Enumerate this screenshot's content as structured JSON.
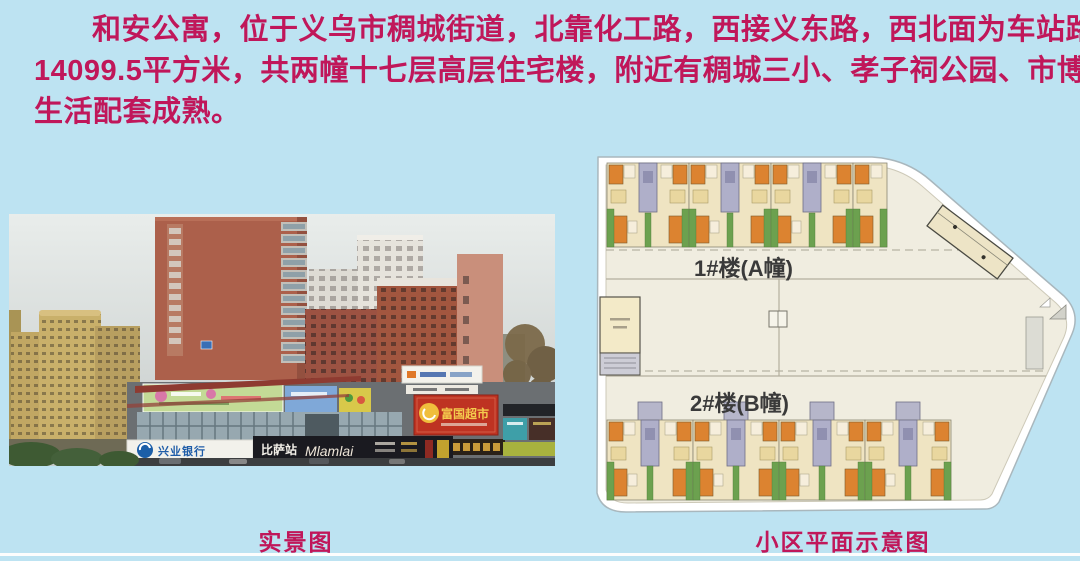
{
  "description": {
    "lines": [
      "和安公寓，位于义乌市稠城街道，北靠化工路，西接义东路，西北面为车站路。小区占地",
      "14099.5平方米，共两幢十七层高层住宅楼，附近有稠城三小、孝子祠公园、市博物馆，周边",
      "生活配套成熟。"
    ]
  },
  "photo": {
    "caption": "实景图",
    "signs": {
      "bank": "兴业银行",
      "pizza": "比萨站",
      "brand": "Mlamlai",
      "market": "富国超市"
    }
  },
  "plan": {
    "caption": "小区平面示意图",
    "building_a": "1#楼(A幢)",
    "building_b": "2#楼(B幢)",
    "row_a_x": [
      607,
      689,
      771
    ],
    "row_a_w": 82,
    "row_a_y": 163,
    "row_a_extra_x": 853,
    "row_b_x": [
      607,
      693,
      779,
      865
    ],
    "row_b_w": 86,
    "row_b_y": 402
  },
  "colors": {
    "background": "#BDE3F2",
    "headline_text": "#C0175A",
    "plan_base": "#F0EDE0",
    "plan_orange": "#DC8330",
    "plan_green": "#6CA14F",
    "plan_core_gray": "#AFAFC9",
    "market_sign_red": "#BE3322",
    "bank_blue": "#1B5EA8"
  }
}
